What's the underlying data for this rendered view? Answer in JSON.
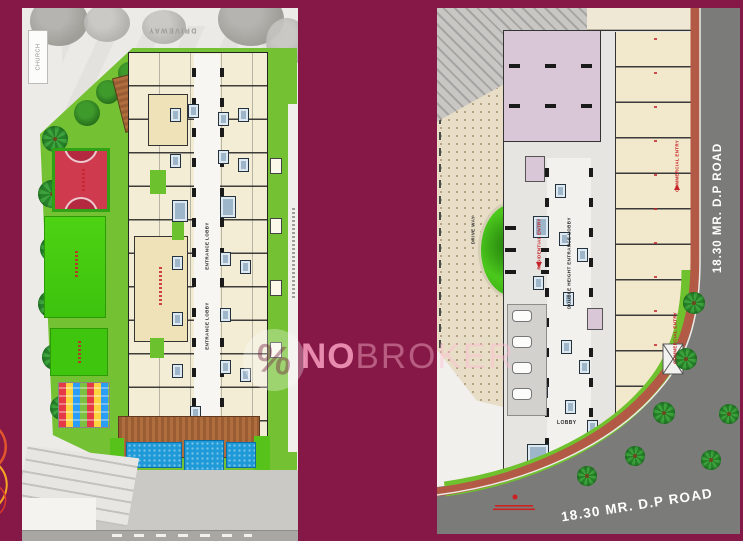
{
  "watermark": {
    "brand_bold": "NO",
    "brand_light": "BROKER",
    "percent_glyph": "%"
  },
  "left_plan": {
    "labels": {
      "church": "CHURCH",
      "driveway": "DRIVEWAY",
      "entrance_lobby_upper": "ENTRANCE LOBBY",
      "entrance_lobby_lower": "ENTRANCE LOBBY"
    }
  },
  "right_plan": {
    "labels": {
      "double_height_lobby": "DOUBLE HEIGHT ENTRANCE LOBBY",
      "drive_way_left": "DRIVE WAY",
      "drive_way_right": "DRIVE WAY",
      "residential_entry": "RESIDENTIAL ENTRY",
      "commercial_entry_upper": "COMMERCIAL ENTRY",
      "commercial_entry_lower": "COMMERCIAL ENTRY",
      "lobby": "LOBBY",
      "road_side": "18.30 MR. D.P ROAD",
      "road_bottom": "18.30 MR. D.P ROAD"
    }
  },
  "palette": {
    "background": "#851847",
    "watermark_pink": "#f2a8c4",
    "podium_green": "#74c233",
    "lawn_green": "#46d013",
    "court_red": "#cf3a50",
    "pool_blue": "#1f9ad8",
    "deck_brown": "#a8673c",
    "unit_cream": "#f3edd6",
    "shops_cream": "#f2e8cc",
    "lavender": "#d9c6d6",
    "stair_blue": "#9db6ca",
    "road_dark": "#7b7b79",
    "footpath_red": "#b25a45",
    "plaza_beige": "#e8ddc6",
    "label_red": "#c6242b"
  }
}
